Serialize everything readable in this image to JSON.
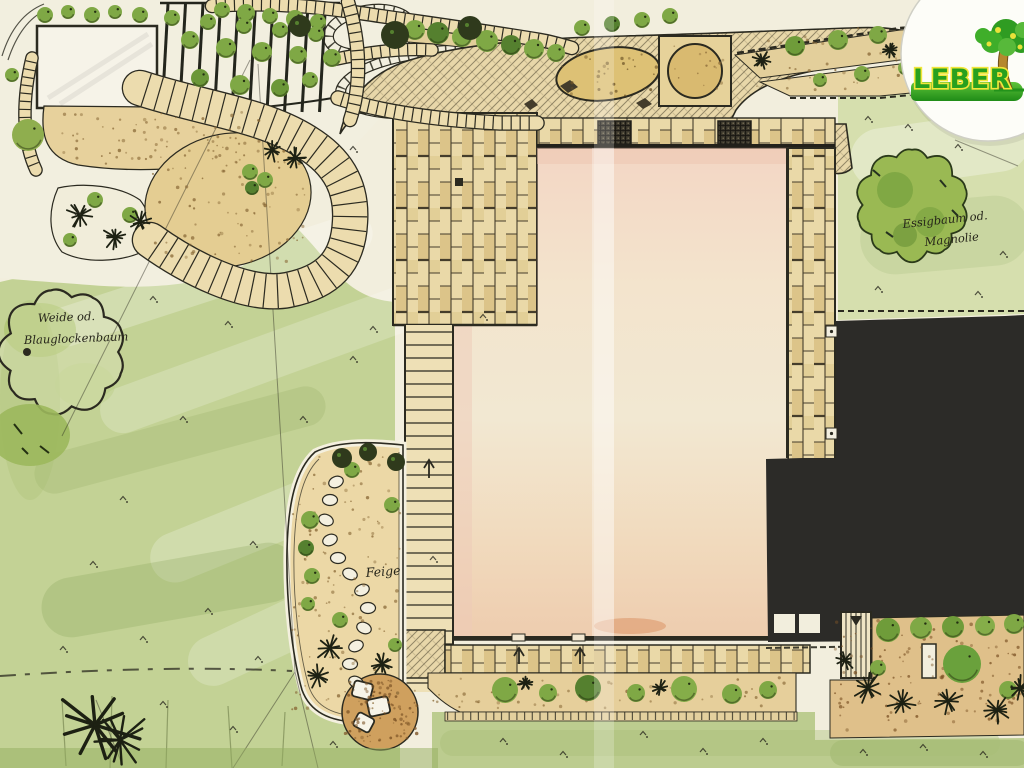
{
  "plan": {
    "kind": "hand-drawn garden landscape plan",
    "labels": {
      "left_tree_line1": "Weide od.",
      "left_tree_line2": "Blauglockenbaum",
      "right_tree_line1": "Essigbaum od.",
      "right_tree_line2": "Magnolie",
      "fig_tree": "Feige"
    },
    "logo": {
      "text": "LEBER"
    },
    "colors": {
      "paper": "#f2eedd",
      "lawn": "#c3d295",
      "lawn_light": "#d6dfae",
      "paving": "#e9d8a7",
      "gravel": "#e5cf9b",
      "house": "#f3e3cd",
      "house_pink": "#f3d6c4",
      "redacted": "#2c2b28",
      "ink": "#2b2a20",
      "foliage": "#7fa845",
      "logo_green": "#28a01e",
      "logo_yellow": "#f2e63a"
    }
  }
}
